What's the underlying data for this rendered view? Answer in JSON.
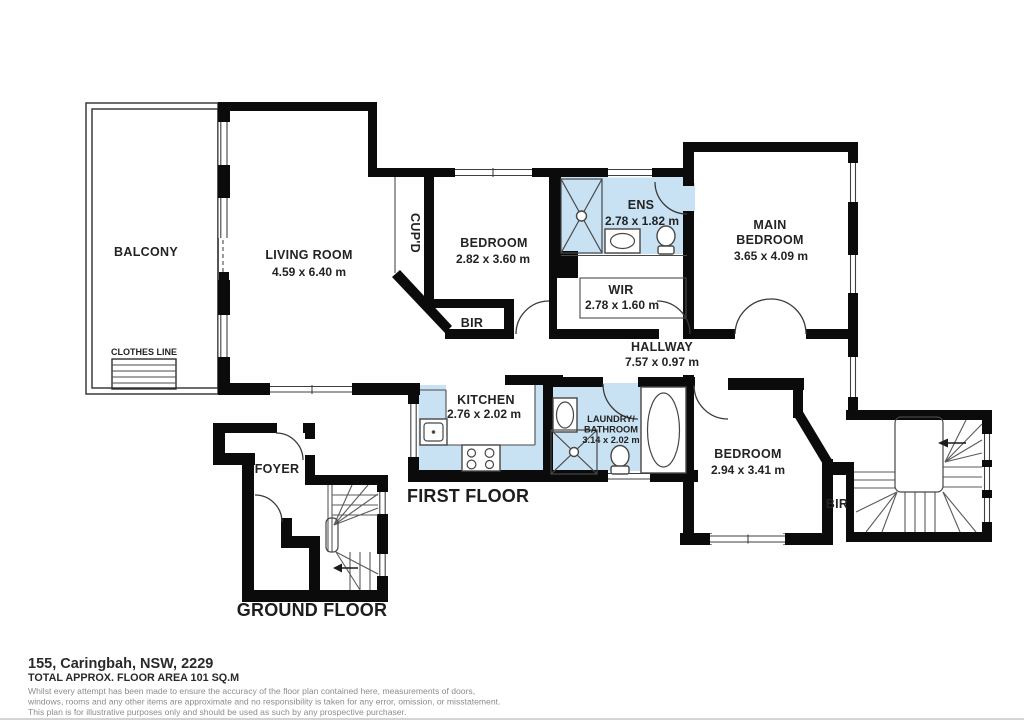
{
  "document": {
    "type": "floor-plan",
    "address": "155, Caringbah, NSW, 2229",
    "total_area": "TOTAL APPROX. FLOOR AREA 101 SQ.M",
    "disclaimer": {
      "line1": "Whilst every attempt has been made to ensure the accuracy of the floor plan contained here, measurements of doors,",
      "line2": "windows, rooms and any other items are approximate and no responsibility is taken for any error, omission, or misstatement.",
      "line3": "This plan is for illustrative purposes only and should be used as such by any prospective purchaser."
    }
  },
  "floors": {
    "first": {
      "label": "FIRST FLOOR",
      "rooms": {
        "balcony": {
          "name": "BALCONY"
        },
        "clothes_line": {
          "name": "CLOTHES LINE"
        },
        "living_room": {
          "name": "LIVING ROOM",
          "dims": "4.59 x 6.40 m"
        },
        "cupboard": {
          "name": "CUP'D"
        },
        "bedroom1": {
          "name": "BEDROOM",
          "dims": "2.82 x 3.60 m",
          "robe": "BIR"
        },
        "ens": {
          "name": "ENS",
          "dims": "2.78 x 1.82 m"
        },
        "main_bedroom": {
          "name_line1": "MAIN",
          "name_line2": "BEDROOM",
          "dims": "3.65 x 4.09 m"
        },
        "wir": {
          "name": "WIR",
          "dims": "2.78 x 1.60 m"
        },
        "hallway": {
          "name": "HALLWAY",
          "dims": "7.57 x 0.97 m"
        },
        "kitchen": {
          "name": "KITCHEN",
          "dims": "2.76 x 2.02 m"
        },
        "laundry_bathroom": {
          "name_line1": "LAUNDRY/",
          "name_line2": "BATHROOM",
          "dims": "3.14 x 2.02 m"
        },
        "bedroom2": {
          "name": "BEDROOM",
          "dims": "2.94 x 3.41 m",
          "robe": "BIR"
        }
      }
    },
    "ground": {
      "label": "GROUND FLOOR",
      "rooms": {
        "foyer": {
          "name": "FOYER"
        }
      }
    }
  },
  "colors": {
    "wall": "#0b0b0b",
    "wet_area_fill": "#c9e2f3",
    "shower_fill": "#bcd9ee",
    "line": "#444444",
    "text": "#232323",
    "muted_text": "#8c8c8c"
  }
}
